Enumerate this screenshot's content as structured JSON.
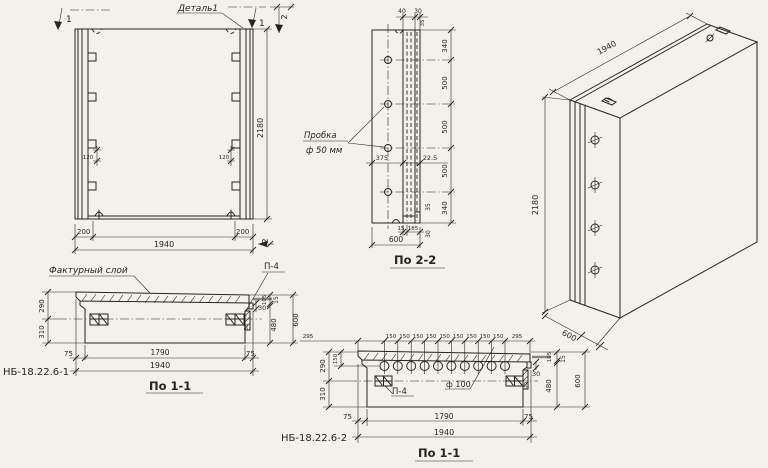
{
  "palette": {
    "paper": "#f3f1ea",
    "ink": "#26241f"
  },
  "front_view": {
    "detail_label": "Деталь1",
    "marker_1_left": "1",
    "marker_1_right": "1",
    "marker_2_top": "2",
    "marker_2_bottom": "2",
    "dim_height": "2180",
    "dim_groove_left": "120",
    "dim_groove_right": "120",
    "dim_rib_left": "200",
    "dim_rib_right": "200",
    "dim_width": "1940"
  },
  "section_2_2": {
    "title": "По 2-2",
    "dim_40": "40",
    "dim_30_top": "30",
    "dim_35_top": "35",
    "plug_line1": "Пробка",
    "plug_line2": "ф 50 мм",
    "dim_375": "375",
    "dim_22_5": "22.5",
    "right_dims": [
      "340",
      "500",
      "500",
      "500",
      "340"
    ],
    "dim_15": "15",
    "dim_185": "185",
    "dim_600": "600",
    "dim_30_right": "30",
    "dim_35_right": "35"
  },
  "iso_view": {
    "dim_length": "1940",
    "dim_height": "2180",
    "dim_depth": "600"
  },
  "section_1_1_a": {
    "mark": "НБ-18.22.6-1",
    "title": "По 1-1",
    "texture_label": "Фактурный слой",
    "p4_label": "П-4",
    "dim_290": "290",
    "dim_310": "310",
    "dim_30": "30",
    "dim_35": "35",
    "dim_105": "105",
    "dim_15": "15",
    "dim_480": "480",
    "dim_600": "600",
    "dim_75_left": "75",
    "dim_1790": "1790",
    "dim_75_right": "75",
    "dim_1940": "1940"
  },
  "section_1_1_b": {
    "mark": "НБ-18.22.6-2",
    "title": "По 1-1",
    "p4_label": "П-4",
    "hole_label": "ф 100",
    "dim_295_left": "295",
    "dim_150_items": [
      "150",
      "150",
      "150",
      "150",
      "150",
      "150",
      "150",
      "150",
      "150"
    ],
    "dim_295_right": "295",
    "dim_290": "290",
    "dim_150_left": "150",
    "dim_310": "310",
    "dim_30": "30",
    "dim_35": "35",
    "dim_105": "105",
    "dim_15": "15",
    "dim_480": "480",
    "dim_600": "600",
    "dim_75_left": "75",
    "dim_1790": "1790",
    "dim_75_right": "75",
    "dim_1940": "1940"
  }
}
